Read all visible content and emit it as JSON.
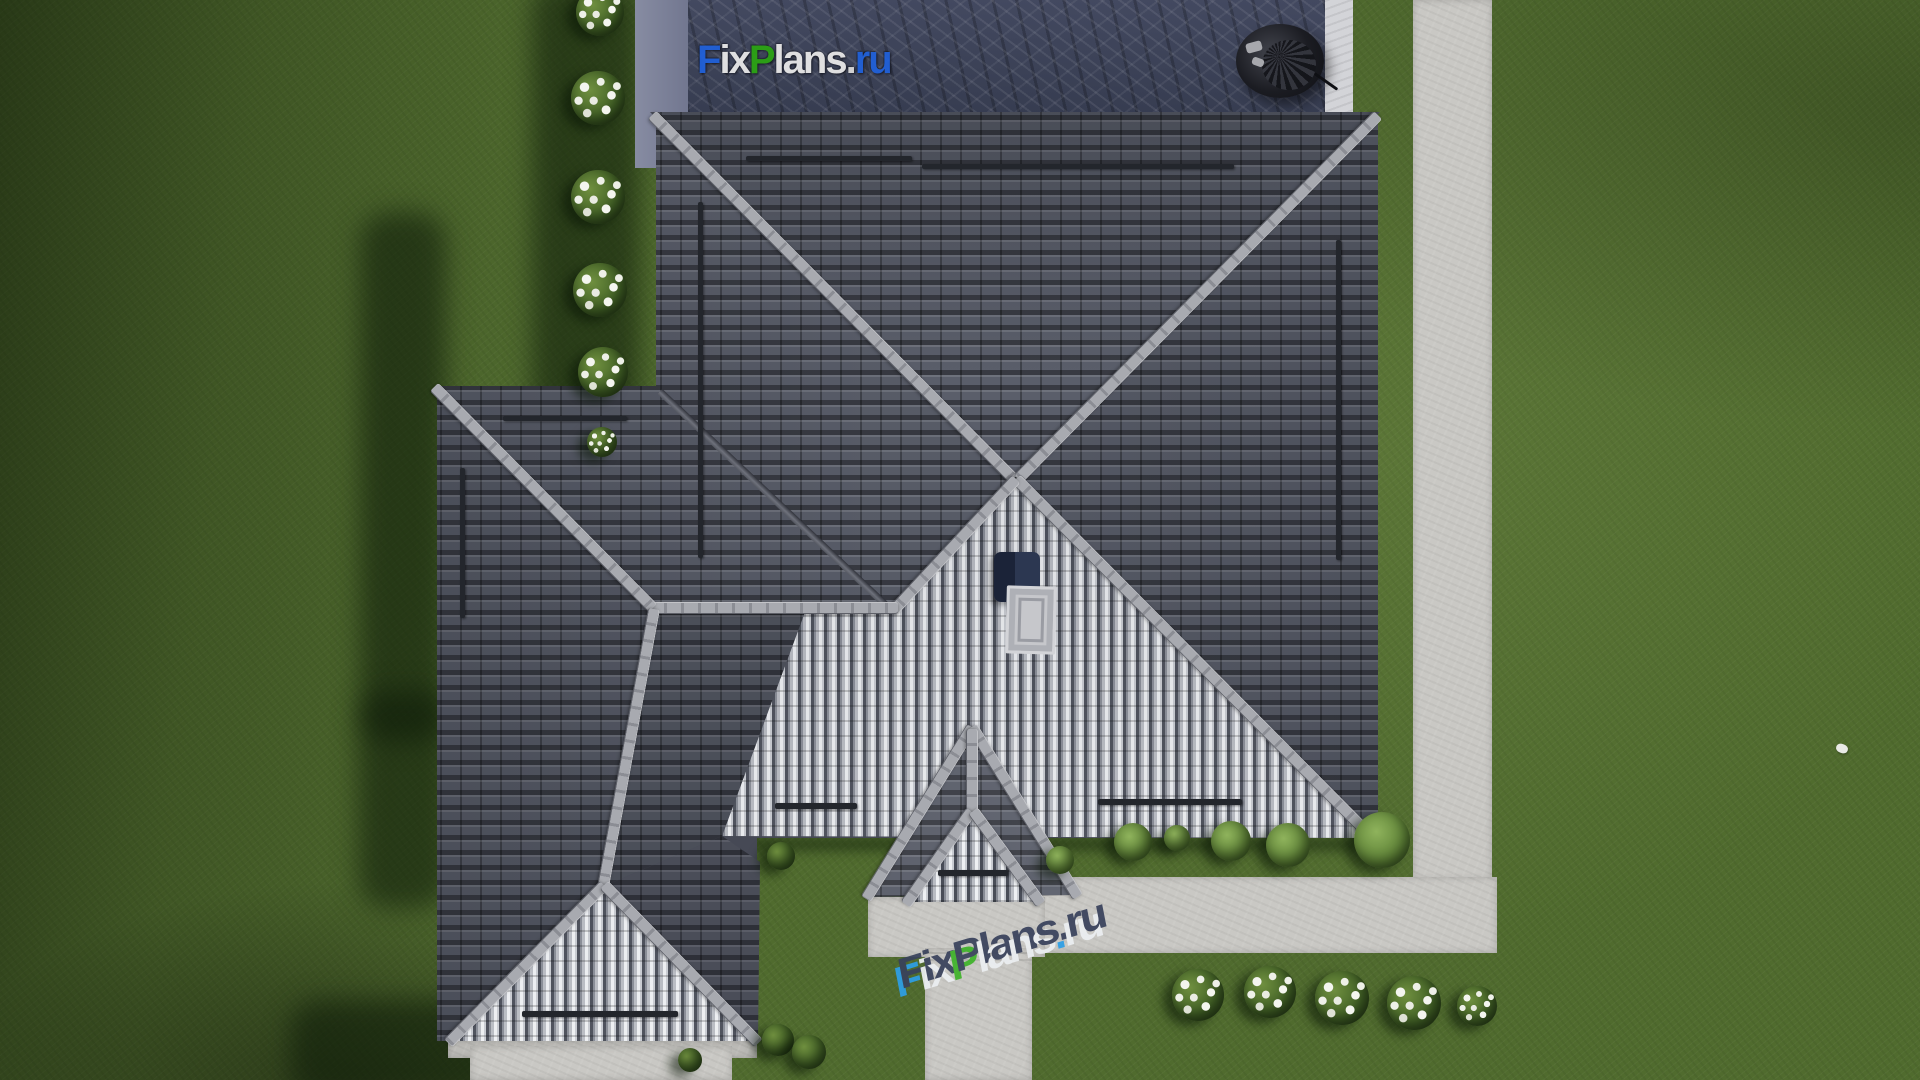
{
  "scene": {
    "watermark_top": {
      "text": "FixPlans.ru",
      "letters": [
        {
          "ch": "F",
          "color": "#2060d8"
        },
        {
          "ch": "i",
          "color": "#e8e8e8"
        },
        {
          "ch": "x",
          "color": "#e8e8e8"
        },
        {
          "ch": "P",
          "color": "#2ba313"
        },
        {
          "ch": "l",
          "color": "#e8e8e8"
        },
        {
          "ch": "a",
          "color": "#e8e8e8"
        },
        {
          "ch": "n",
          "color": "#e8e8e8"
        },
        {
          "ch": "s",
          "color": "#e8e8e8"
        },
        {
          "ch": ".",
          "color": "#d8d8d8"
        },
        {
          "ch": "r",
          "color": "#2060d8"
        },
        {
          "ch": "u",
          "color": "#2060d8"
        }
      ]
    },
    "watermark_ground": {
      "text": "FixPlans.ru",
      "top_color": "#39425c",
      "letters": [
        {
          "ch": "F",
          "face": "#2e9fe6"
        },
        {
          "ch": "i",
          "face": "#eceff2"
        },
        {
          "ch": "x",
          "face": "#eceff2"
        },
        {
          "ch": "P",
          "face": "#3fb32a"
        },
        {
          "ch": "l",
          "face": "#eceff2"
        },
        {
          "ch": "a",
          "face": "#eceff2"
        },
        {
          "ch": "n",
          "face": "#eceff2"
        },
        {
          "ch": "s",
          "face": "#eceff2"
        },
        {
          "ch": ".",
          "face": "#2e9fe6"
        },
        {
          "ch": "r",
          "face": "#eceff2"
        },
        {
          "ch": "u",
          "face": "#eceff2"
        }
      ]
    },
    "palette": {
      "grass": "#506b2e",
      "grass_shadow": "#1e3314",
      "roof_dark": "#5a5e6a",
      "roof_bright": "#e8e9ec",
      "ridge_cap": "#a2a4aa",
      "path_concrete": "#c9c8c4",
      "terrace_stone": "#3c4256",
      "terrace_border": "#7d8297",
      "marble_strip": "#d3d4d8",
      "chimney": "#232c47",
      "skylight": "#c6c7cb",
      "furniture": "#16171c",
      "bush_foliage": "#3f5e24",
      "bush_flowers": "#f2f3ee"
    }
  }
}
